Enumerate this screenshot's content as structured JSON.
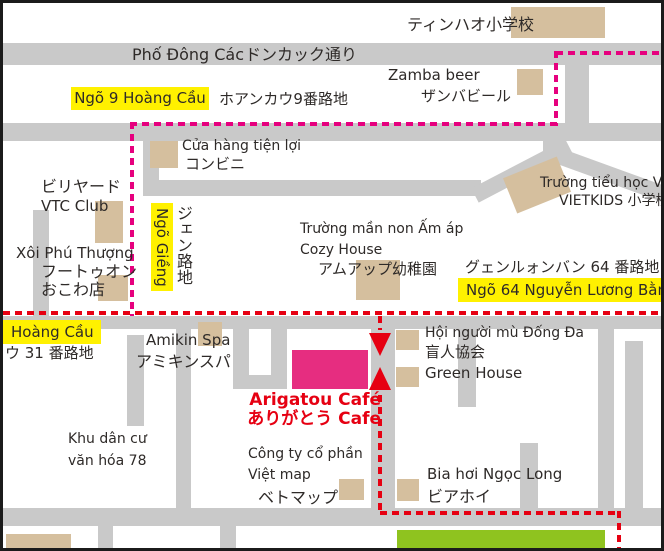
{
  "title": "Arigatou Café access map",
  "colors": {
    "road": "#c9c9c9",
    "building": "#d5bf9e",
    "highlight_yellow": "#fff100",
    "route_pink": "#e6007e",
    "route_red": "#e60012",
    "cafe_pink": "#e62d80",
    "green_area": "#8fc31f",
    "text": "#2e2a28",
    "frame": "#1b1b1b"
  },
  "labels": {
    "tinhao_school": {
      "jp": "ティンハオ小学校"
    },
    "pho_dong_cac": {
      "vi": "Phố Đông Các",
      "jp": "ドンカック通り"
    },
    "ngo9_hoang_cau": {
      "vi": "Ngõ 9 Hoàng Cầu",
      "jp": "ホアンカウ9番路地"
    },
    "zamba_beer": {
      "en": "Zamba beer",
      "jp": "ザンバビール"
    },
    "convenience_store": {
      "vi": "Cửa hàng tiện lợi",
      "jp": "コンビニ"
    },
    "vtc_club": {
      "jp": "ビリヤード",
      "en": "VTC Club"
    },
    "xoi_phu_thuong": {
      "vi": "Xôi Phú Thượng",
      "jp1": "フートゥオン",
      "jp2": "おこわ店"
    },
    "ngo_gieng": {
      "vi": "Ngõ Giềng",
      "jp": "ジェン路地"
    },
    "cozy_house": {
      "vi": "Trường mần non Ấm áp",
      "en": "Cozy House",
      "jp": "アムアップ幼稚園"
    },
    "vietkids": {
      "vi": "Trường tiểu học VI",
      "jp": "VIETKIDS 小学校"
    },
    "ngo64_nguyen_luong_bang": {
      "jp": "グェンルォンバン 64 番路地",
      "vi": "Ngõ 64 Nguyễn Lương Bằng"
    },
    "ngo31_hoang_cau": {
      "vi": "Hoàng Cầu",
      "jp": "ウ 31 番路地"
    },
    "amikin_spa": {
      "en": "Amikin Spa",
      "jp": "アミキンスパ"
    },
    "khu_dan_cu": {
      "line1": "Khu dân cư",
      "line2": "văn hóa 78"
    },
    "arigatou_cafe": {
      "en": "Arigatou Café",
      "jp": "ありがとう Cafe"
    },
    "blind_association": {
      "vi": "Hội người mù Đống Đa",
      "jp": "盲人協会"
    },
    "green_house": {
      "en": "Green House"
    },
    "viet_map": {
      "l1": "Công ty cổ phần",
      "l2": "Việt map",
      "jp": "ベトマップ"
    },
    "bia_hoi_ngoc_long": {
      "vi": "Bia hơi Ngọc Long",
      "jp": "ビアホイ"
    }
  }
}
